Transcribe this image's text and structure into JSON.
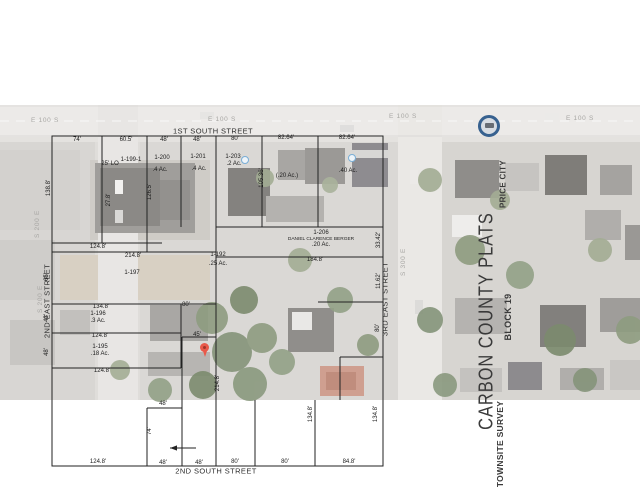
{
  "title_block": {
    "plats": "CARBON COUNTY PLATS",
    "price_city": "PRICE CITY",
    "block": "BLOCK 19",
    "survey": "TOWNSITE SURVEY"
  },
  "colors": {
    "pin_red": "#e8594a",
    "logo_blue": "#37618f",
    "poi_blue": "#79aed6",
    "line_black": "#222222",
    "title_gray": "#3a3a3a",
    "aerial_label_gray": "#a8a7a4"
  },
  "labels": [
    {
      "t": "1ST SOUTH STREET",
      "x": 213,
      "y": 131,
      "k": "s"
    },
    {
      "t": "2ND SOUTH STREET",
      "x": 216,
      "y": 471,
      "k": "s"
    },
    {
      "t": "2ND EAST STREET",
      "x": 47,
      "y": 301,
      "k": "s",
      "r": 1
    },
    {
      "t": "3RD EAST STREET",
      "x": 385,
      "y": 299,
      "k": "s",
      "r": 1
    },
    {
      "t": "E 100 S",
      "x": 45,
      "y": 121,
      "k": "a"
    },
    {
      "t": "E 100 S",
      "x": 222,
      "y": 120,
      "k": "a"
    },
    {
      "t": "E 100 S",
      "x": 403,
      "y": 117,
      "k": "a"
    },
    {
      "t": "E 100 S",
      "x": 580,
      "y": 119,
      "k": "a"
    },
    {
      "t": "S 200 E",
      "x": 38,
      "y": 224,
      "k": "a",
      "r": 1
    },
    {
      "t": "S 200 E",
      "x": 41,
      "y": 299,
      "k": "a",
      "r": 1
    },
    {
      "t": "S 300 E",
      "x": 404,
      "y": 262,
      "k": "a",
      "r": 1
    },
    {
      "t": "74'",
      "x": 77,
      "y": 140,
      "k": "d"
    },
    {
      "t": "60.5'",
      "x": 126,
      "y": 140,
      "k": "d"
    },
    {
      "t": "48'",
      "x": 164,
      "y": 140,
      "k": "d"
    },
    {
      "t": "48'",
      "x": 197,
      "y": 140,
      "k": "d"
    },
    {
      "t": "80'",
      "x": 235,
      "y": 139,
      "k": "d"
    },
    {
      "t": "82.64'",
      "x": 286,
      "y": 138,
      "k": "d"
    },
    {
      "t": "82.64'",
      "x": 347,
      "y": 138,
      "k": "d"
    },
    {
      "t": "124.8'",
      "x": 98,
      "y": 247,
      "k": "d"
    },
    {
      "t": "214.8'",
      "x": 133,
      "y": 256,
      "k": "d"
    },
    {
      "t": "134.8'",
      "x": 101,
      "y": 307,
      "k": "d"
    },
    {
      "t": "80'",
      "x": 186,
      "y": 305,
      "k": "d"
    },
    {
      "t": "124.8'",
      "x": 100,
      "y": 336,
      "k": "d"
    },
    {
      "t": "124.8'",
      "x": 102,
      "y": 371,
      "k": "d"
    },
    {
      "t": "184.8'",
      "x": 315,
      "y": 260,
      "k": "d"
    },
    {
      "t": "45'",
      "x": 197,
      "y": 335,
      "k": "d"
    },
    {
      "t": "48'",
      "x": 163,
      "y": 404,
      "k": "d"
    },
    {
      "t": "124.8'",
      "x": 98,
      "y": 462,
      "k": "d"
    },
    {
      "t": "48'",
      "x": 163,
      "y": 463,
      "k": "d"
    },
    {
      "t": "48'",
      "x": 199,
      "y": 463,
      "k": "d"
    },
    {
      "t": "80'",
      "x": 235,
      "y": 462,
      "k": "d"
    },
    {
      "t": "80'",
      "x": 285,
      "y": 462,
      "k": "d"
    },
    {
      "t": "84.8'",
      "x": 349,
      "y": 462,
      "k": "d"
    },
    {
      "t": "138.8'",
      "x": 49,
      "y": 188,
      "k": "d",
      "r": 1
    },
    {
      "t": "65'",
      "x": 47,
      "y": 277,
      "k": "d",
      "r": 1
    },
    {
      "t": "43'",
      "x": 47,
      "y": 318,
      "k": "d",
      "r": 1
    },
    {
      "t": "48'",
      "x": 47,
      "y": 352,
      "k": "d",
      "r": 1
    },
    {
      "t": "126.5'",
      "x": 150,
      "y": 192,
      "k": "d",
      "r": 1
    },
    {
      "t": "27.8'",
      "x": 109,
      "y": 200,
      "k": "d",
      "r": 1
    },
    {
      "t": "105.36'",
      "x": 262,
      "y": 178,
      "k": "d",
      "r": 1
    },
    {
      "t": "33.42'",
      "x": 379,
      "y": 240,
      "k": "d",
      "r": 1
    },
    {
      "t": "11.62'",
      "x": 379,
      "y": 281,
      "k": "d",
      "r": 1
    },
    {
      "t": "80'",
      "x": 378,
      "y": 328,
      "k": "d",
      "r": 1
    },
    {
      "t": "214.8'",
      "x": 218,
      "y": 383,
      "k": "d",
      "r": 1
    },
    {
      "t": "134.8'",
      "x": 311,
      "y": 414,
      "k": "d",
      "r": 1
    },
    {
      "t": "134.8'",
      "x": 376,
      "y": 414,
      "k": "d",
      "r": 1
    },
    {
      "t": "74'",
      "x": 150,
      "y": 431,
      "k": "d",
      "r": 1
    },
    {
      "t": "25' LO",
      "x": 110,
      "y": 164,
      "k": "p"
    },
    {
      "t": "1-199-1",
      "x": 131,
      "y": 160,
      "k": "p"
    },
    {
      "t": "1-200",
      "x": 162,
      "y": 158,
      "k": "p"
    },
    {
      "t": ".4 Ac.",
      "x": 160,
      "y": 170,
      "k": "p"
    },
    {
      "t": "1-201",
      "x": 198,
      "y": 157,
      "k": "p"
    },
    {
      "t": ".4 Ac.",
      "x": 199,
      "y": 169,
      "k": "p"
    },
    {
      "t": "1-203",
      "x": 233,
      "y": 157,
      "k": "p"
    },
    {
      "t": ".2 Ac.",
      "x": 234,
      "y": 164,
      "k": "p"
    },
    {
      "t": "(.20 Ac.)",
      "x": 287,
      "y": 176,
      "k": "p"
    },
    {
      "t": ".40 Ac.",
      "x": 348,
      "y": 171,
      "k": "p"
    },
    {
      "t": "1-206",
      "x": 321,
      "y": 233,
      "k": "p"
    },
    {
      "t": "DANIEL CLARENCE BERGER",
      "x": 321,
      "y": 239,
      "k": "px"
    },
    {
      "t": ".20 Ac.",
      "x": 321,
      "y": 245,
      "k": "p"
    },
    {
      "t": "1-192",
      "x": 218,
      "y": 255,
      "k": "p"
    },
    {
      "t": ".25 Ac.",
      "x": 218,
      "y": 264,
      "k": "p"
    },
    {
      "t": "1-197",
      "x": 132,
      "y": 273,
      "k": "p"
    },
    {
      "t": "1-196",
      "x": 98,
      "y": 314,
      "k": "p"
    },
    {
      "t": ".3 Ac.",
      "x": 98,
      "y": 321,
      "k": "p"
    },
    {
      "t": "1-195",
      "x": 100,
      "y": 347,
      "k": "p"
    },
    {
      "t": ".18 Ac.",
      "x": 100,
      "y": 354,
      "k": "p"
    }
  ]
}
